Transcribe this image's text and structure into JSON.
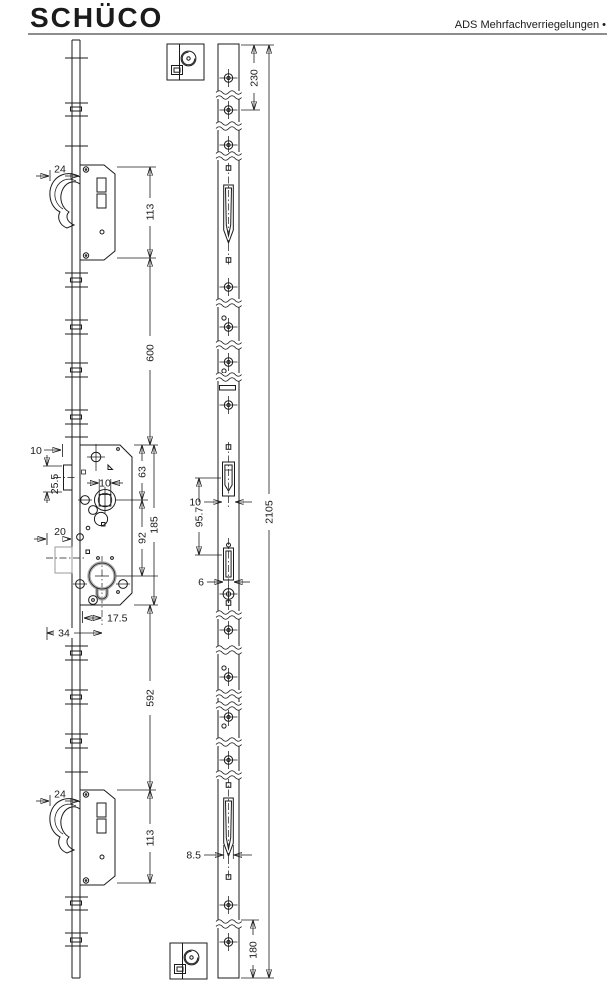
{
  "header": {
    "brand": "SCHÜCO",
    "product_line": "ADS Mehrfachverriegelungen •"
  },
  "side_view_dims": {
    "top_lock_backset": "24",
    "top_lock_height": "113",
    "top_to_center_spacing": "600",
    "faceplate_width": "10",
    "slot_length": "25.5",
    "handle_plate_width": "20",
    "follower_square": "10",
    "top_to_follower": "63",
    "follower_to_cylinder": "92",
    "case_height": "185",
    "cylinder_offset": "17.5",
    "case_offset": "34",
    "center_to_bottom_spacing": "592",
    "bottom_lock_backset": "24",
    "bottom_lock_height": "113"
  },
  "faceplate_dims": {
    "top_screw_spacing": "230",
    "latch_slot_width": "10",
    "latch_to_bolt": "95.7",
    "bolt_slot_width": "6",
    "hook_slot_width": "8.5",
    "bottom_screw_spacing": "180",
    "total_length": "2105"
  }
}
